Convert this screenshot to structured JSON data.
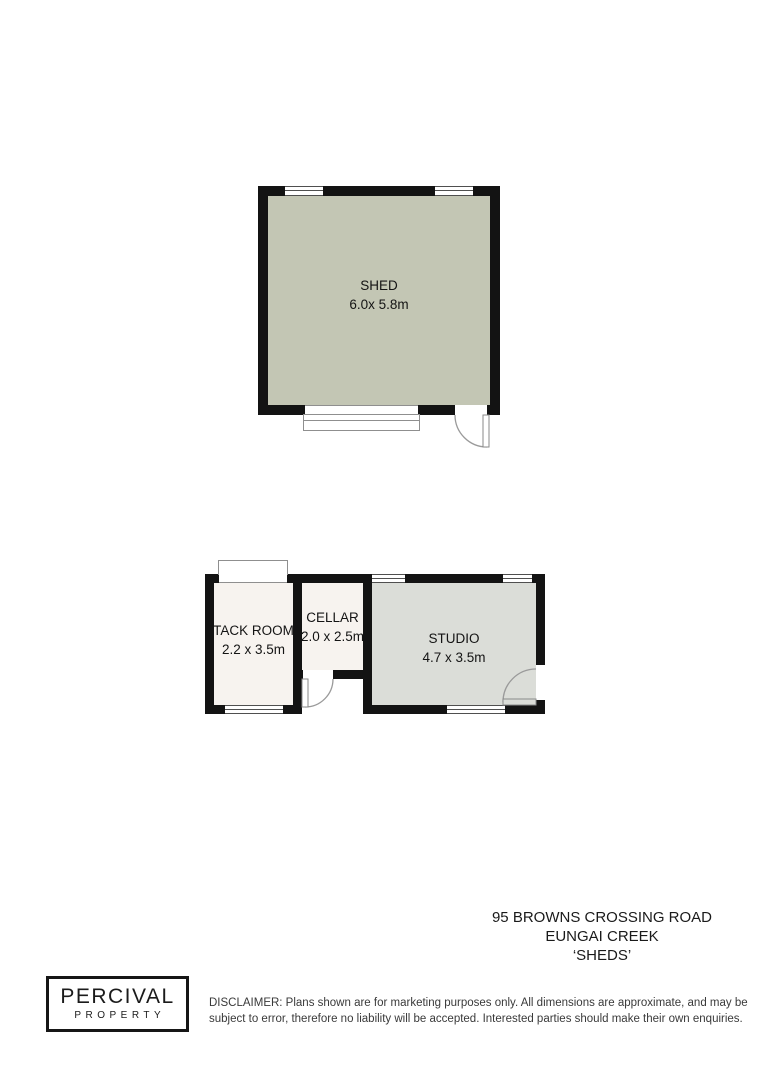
{
  "plan": {
    "shed": {
      "name": "SHED",
      "dims": "6.0x 5.8m"
    },
    "tack_room": {
      "name": "TACK ROOM",
      "dims": "2.2 x 3.5m"
    },
    "cellar": {
      "name": "CELLAR",
      "dims": "2.0 x 2.5m"
    },
    "studio": {
      "name": "STUDIO",
      "dims": "4.7 x 3.5m"
    }
  },
  "address": {
    "line1": "95 BROWNS CROSSING ROAD",
    "line2": "EUNGAI CREEK",
    "line3": "‘SHEDS’"
  },
  "footer": {
    "logo_line1": "PERCIVAL",
    "logo_line2": "PROPERTY",
    "disclaimer_line1": "DISCLAIMER: Plans shown are for marketing purposes only. All dimensions are approximate, and may be",
    "disclaimer_line2": "subject to error, therefore no liability will be accepted. Interested parties should make their own enquiries."
  },
  "colors": {
    "wall": "#131313",
    "shed_fill": "#c3c6b4",
    "studio_fill": "#dbddd8",
    "room_fill": "#f7f3ef"
  }
}
